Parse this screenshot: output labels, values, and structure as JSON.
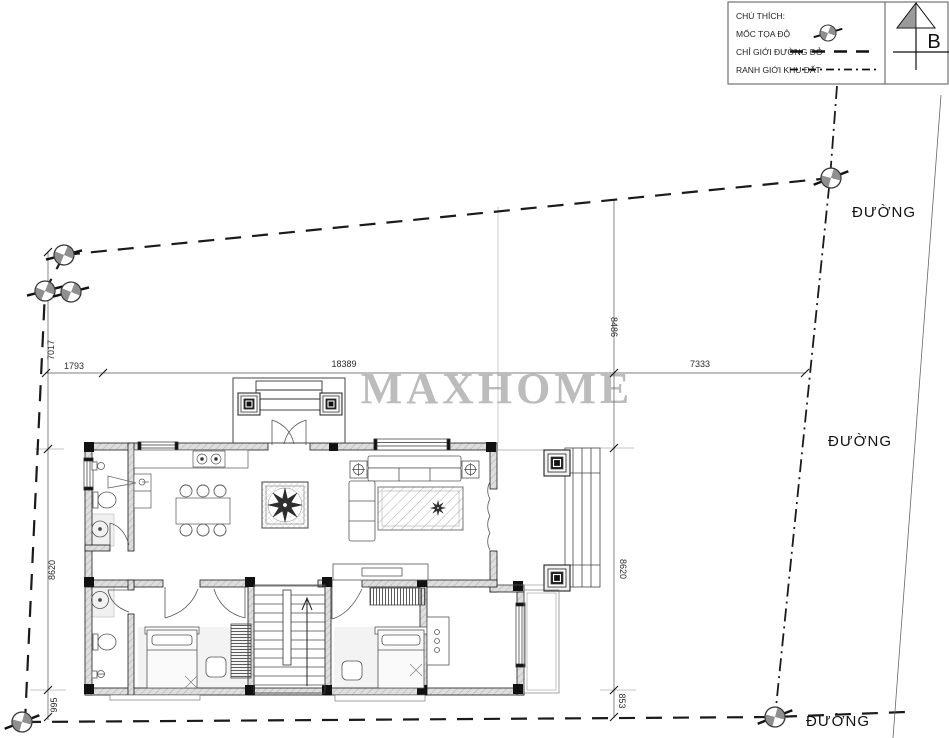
{
  "legend": {
    "title": "CHÚ THÍCH:",
    "items": [
      {
        "label": "MỐC TỌA ĐỘ",
        "symbol": "coordinate-marker"
      },
      {
        "label": "CHỈ GIỚI ĐƯỜNG ĐỎ",
        "symbol": "dashed-line"
      },
      {
        "label": "RANH GIỚI KHU ĐẤT",
        "symbol": "dash-dot-line"
      }
    ]
  },
  "north": {
    "label": "B"
  },
  "watermark": {
    "text": "MAXHOME"
  },
  "roads": {
    "top": "ĐƯỜNG",
    "middle": "ĐƯỜNG",
    "bottom": "ĐƯỜNG"
  },
  "dimensions": {
    "d7017": "7017",
    "d1793": "1793",
    "d18389": "18389",
    "d7333": "7333",
    "d8486": "8486",
    "d8620_left": "8620",
    "d8620_right": "8620",
    "d853": "853",
    "d995": "995"
  },
  "colors": {
    "wall_fill": "#dedede",
    "line": "#1a1a1a",
    "watermark": "#b5b5b5"
  }
}
